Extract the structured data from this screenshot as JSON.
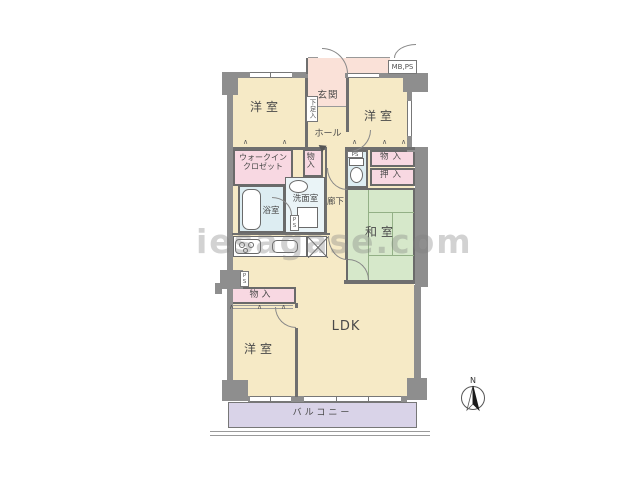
{
  "labels": {
    "bedroom_tl": "洋室",
    "bedroom_tr": "洋室",
    "bedroom_bl": "洋室",
    "entrance": "玄関",
    "hall": "ホール",
    "shoe_box": "下足入",
    "mb_ps": "MB,PS",
    "walkin_line1": "ウォークイン",
    "walkin_line2": "クロゼット",
    "storage_hall": "物入",
    "storage_east": "物入",
    "oshiire": "押入",
    "washroom": "洗面室",
    "bathroom": "浴室",
    "corridor": "廊下",
    "tatami": "和室",
    "storage_bl": "物入",
    "ldk": "LDK",
    "balcony": "バルコニー",
    "ps_toilet": "PS",
    "ps_west": "PS",
    "ps_wash": "PS"
  },
  "compass": {
    "north": "N"
  },
  "marks": {
    "hanger": "∧"
  },
  "watermark": "iesagase.com",
  "colors": {
    "room_cream": "#f6eac6",
    "closet_pink": "#f8d8e2",
    "entrance_pink": "#fae1d8",
    "wet_blue": "#ddedf2",
    "washroom_pale": "#eaf4f7",
    "tatami_green": "#d6e8ca",
    "balcony_lavender": "#d9d3e8",
    "wall_gray": "#8e8e8e"
  }
}
